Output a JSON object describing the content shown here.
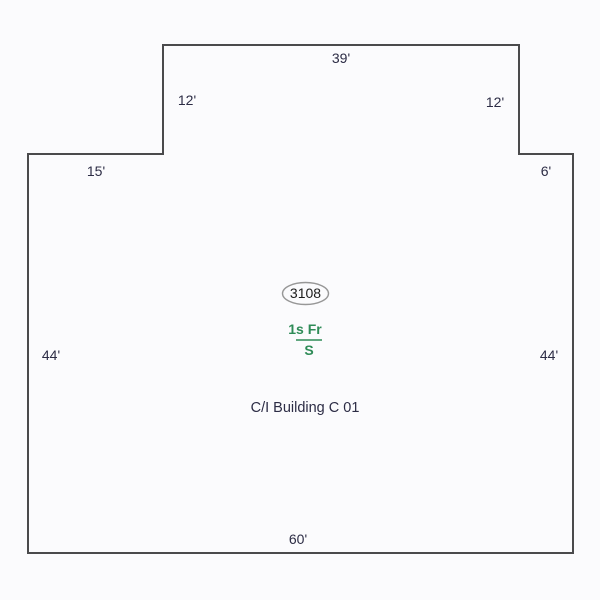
{
  "sketch": {
    "building_label": "C/I Building C 01",
    "area_tag": "3108",
    "story_label": {
      "numerator": "1s Fr",
      "denominator": "S"
    },
    "dimensions": {
      "top": "39'",
      "upper_left_side": "12'",
      "upper_right_side": "12'",
      "left_shoulder": "15'",
      "right_shoulder": "6'",
      "left_side": "44'",
      "right_side": "44'",
      "bottom": "60'"
    },
    "colors": {
      "background": "#fbfbfd",
      "outline": "#4a4a4c",
      "dimension_text": "#2c2c45",
      "story_text": "#2e8b57",
      "tag_text": "#1c1c1c",
      "tag_oval": "#979797"
    }
  }
}
